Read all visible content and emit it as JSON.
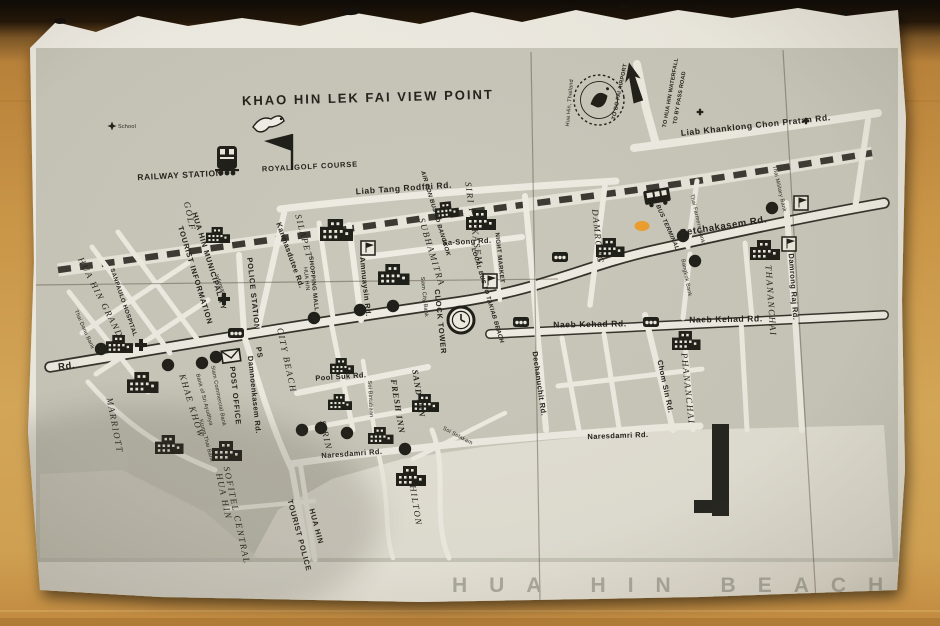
{
  "photo": {
    "scene": "photocopied tourist street map of Hua Hin lying on a wooden table",
    "colors": {
      "wood": "#c0883d",
      "dark_backdrop": "#140e08",
      "paper": "#efece2",
      "map_block_gray": "#c9c8bb",
      "ink": "#22221c",
      "beach_caption_gray": "#aeaca0",
      "highlighter_orange": "#f09a1e"
    }
  },
  "map": {
    "title": "KHAO HIN LEK FAI VIEW POINT",
    "labels": {
      "title": "KHAO HIN LEK FAI VIEW POINT",
      "royal_golf_course": "ROYAL GOLF COURSE",
      "railway_station": "RAILWAY STATION",
      "school": "School",
      "golf": "GOLF",
      "liab_tang_rodfai": "Liab Tang Rodfai Rd.",
      "liab_khanklong": "Liab Khanklong Chon Pratan Rd.",
      "to_bo_fai_airport": "TO BO FAI AIRPORT",
      "to_hua_hin_waterfall": "TO HUA HIN WATERFALL",
      "to_by_pass_road": "TO BY PASS ROAD",
      "hua_hin_thailand": "Hua Hin, Thailand",
      "petchakasem": "Petchakasem Rd.",
      "rd_left": "Rd.",
      "naeb_kehad_left": "Naeb Kehad Rd.",
      "naeb_kehad_right": "Naeb Kehad Rd.",
      "sa_song": "Sa-Song Rd.",
      "naresdamri_left": "Naresdamri Rd.",
      "naresdamri_right": "Naresdamri Rd.",
      "pool_suk": "Pool Suk Rd.",
      "damnoenkasem": "Damnoenkasem Rd.",
      "chom_sin": "Chom Sin Rd.",
      "damrong_raj": "Damrong Raj Rd.",
      "dechanuchit": "Dechanuchit Rd.",
      "amnuaysin": "Amnuaysin Rd.",
      "kanmasdutee": "Kanmasdutee Rd.",
      "soi_bintabaan": "Soi Bintabaan",
      "soi_selakam": "Soi Selakam",
      "silapet": "SILAPET",
      "subhamitra": "SUBHAMITRA",
      "siri_petkasem": "SIRI PETKASEM",
      "damrong": "DAMRONG",
      "thananchai": "THANANCHAI",
      "phananchai": "PHANANCHAI",
      "city_beach": "CITY BEACH",
      "sirin": "SIRIN",
      "khae_khow": "KHAE KHOW",
      "marriott": "MARRIOTT",
      "hua_hin_grand": "HUA HIN GRAND",
      "sand_inn": "SAND INN",
      "fresh_inn": "FRESH INN",
      "hilton": "HILTON",
      "sofitel_line1": "SOFITEL CENTRAL",
      "sofitel_line2": "HUA HIN",
      "tourist_police_line1": "HUA HIN",
      "tourist_police_line2": "TOURIST POLICE",
      "police_station": "POLICE STATION",
      "ps": "PS",
      "post_office": "POST OFFICE",
      "night_market": "NIGHT MARKET",
      "local_bus": "LOCAL BUS TO TAKIAB BEACH",
      "aircon_bus": "AIR CON BUS TO BANGKOK",
      "bus_terminal": "BUS TERMINAL",
      "shopping_mall": "SHOPPING MALL",
      "shopping_mall_sub": "HUA HIN",
      "clock_tower": "CLOCK TOWER",
      "siam_city_bank": "Siam City Bank",
      "siam_commercial_bank": "Siam Commercial Bank",
      "bank_of_sri_ayudhya": "Bank of Sri Ayudhya",
      "krung_thai_bank": "Krung Thai Bank",
      "thai_danu_bank": "Thai Danu Bank",
      "thai_farmers_bank": "Thai Farmers Bank",
      "bangkok_bank": "Bangkok Bank",
      "thai_military_bank": "Thai Military Bank",
      "sanpaulo_hospital": "SANPAULO HOSPITAL",
      "municipality_line1": "HUA HIN MUNICIPALITY",
      "municipality_line2": "TOURIST INFORMATION",
      "infirmary": "Infirmary",
      "beach": "HUA HIN BEACH"
    },
    "icons": {
      "train-icon": "locomotive front at railway station",
      "bird-icon": "dove at view point",
      "golf-flag-icon": "golf flag for royal golf course",
      "clock-tower-icon": "clock face in circle",
      "bank-icon": "$ in black circle",
      "samlor-icon": "black cab with wheels",
      "flag-box-icon": "boxed flag marker",
      "envelope-icon": "post office envelope",
      "cross-icon": "hospital cross",
      "star-icon": "school star",
      "north-arrow-icon": "solid arrow to airport",
      "stamp-icon": "round Hua Hin Thailand emblem",
      "bus-icon": "bus at terminal",
      "pier-icon": "black fishing pier bar",
      "highlight-icon": "orange highlighter dot"
    }
  }
}
